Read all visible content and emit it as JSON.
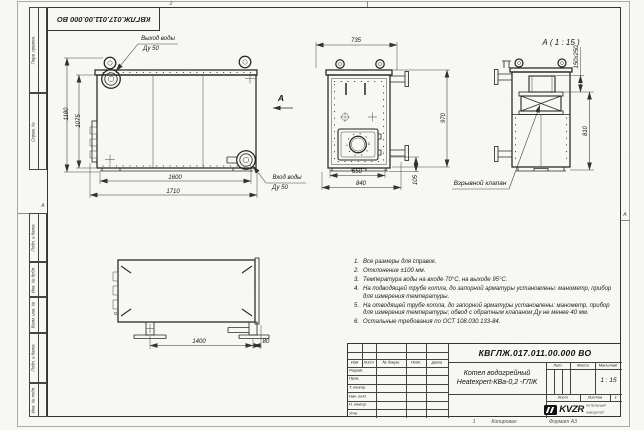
{
  "colors": {
    "paper": "#f7f7f4",
    "ink": "#2a2a24"
  },
  "sheet": {
    "zone_top": "2",
    "zone_bottom_num": "1",
    "zone_left": "А",
    "zone_right": "А",
    "copied": "Копировал",
    "format": "Формат А3"
  },
  "margins": {
    "left_top": [
      "Перв. примен.",
      "Справ. №"
    ],
    "left_bottom": [
      "Подп. и дата",
      "Инв. № дубл.",
      "Взам. инв. №",
      "Подп. и дата",
      "Инв. № подл."
    ]
  },
  "views": {
    "front": {
      "outlet_label": "Выход воды",
      "outlet_dn": "Ду 50",
      "inlet_label": "Вход воды",
      "inlet_dn": "Ду 50",
      "view_letter": "А",
      "dim_height_overall": "1180",
      "dim_height_body": "1075",
      "dim_length_body": "1600",
      "dim_length_overall": "1710"
    },
    "end": {
      "dim_width_top": "735",
      "dim_height": "970",
      "dim_width_inner": "650",
      "dim_width_bottom": "840",
      "dim_skid": "105"
    },
    "viewA": {
      "title": "А ( 1 : 15 )",
      "dim_flue": "150x250",
      "dim_height": "810",
      "callout": "Взрывной клапан"
    },
    "side": {
      "dim_feet": "1400",
      "dim_offset": "80"
    }
  },
  "notes": {
    "items": [
      {
        "n": "1.",
        "text": "Все размеры для справок."
      },
      {
        "n": "2.",
        "text": "Отклонение ±100 мм."
      },
      {
        "n": "3.",
        "text": "Температура воды на входе 70°С, на выходе 95°С."
      },
      {
        "n": "4.",
        "text": "На подводящей трубе котла, до запорной арматуры установлены: манометр, прибор для измерения температуры."
      },
      {
        "n": "5.",
        "text": "На отводящей трубе котла, до запорной арматуры установлены: манометр, прибор для измерения температуры; обвод с обратным клапаном Ду не менее 40 мм."
      },
      {
        "n": "6.",
        "text": "Остальные требования по ОСТ 108.030.133-84."
      }
    ]
  },
  "titleblock": {
    "designation": "КВГЛЖ.017.011.00.000 ВО",
    "product_line1": "Котел водогрейный",
    "product_line2": "Heatexpert-КВа-0,2 -ГЛЖ",
    "header_cols": [
      "Изм",
      "Лист",
      "№ докум.",
      "Подп.",
      "Дата"
    ],
    "rows": [
      "Разраб.",
      "Пров.",
      "Т. контр.",
      "Нач. отд.",
      "Н. контр.",
      "Утв."
    ],
    "lit": "Лит.",
    "mass": "Масса",
    "scale": "Масштаб",
    "scale_value": "1 : 15",
    "sheet": "Лист",
    "sheets": "Листов",
    "sheets_value": "1",
    "org_logo": "KVZR",
    "org_line1": "КОТЕЛЬНЫЙ",
    "org_line2": "ЗАВОД РЭП"
  }
}
